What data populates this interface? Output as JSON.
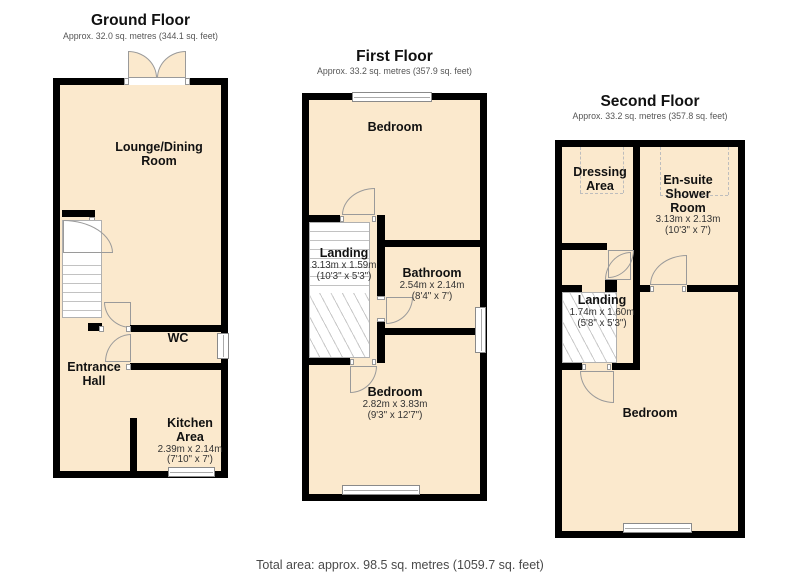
{
  "floors": {
    "ground": {
      "title": "Ground Floor",
      "subtitle": "Approx. 32.0 sq. metres (344.1 sq. feet)",
      "rooms": {
        "lounge": {
          "name": "Lounge/Dining\nRoom"
        },
        "wc": {
          "name": "WC"
        },
        "hall": {
          "name": "Entrance\nHall"
        },
        "kitchen": {
          "name": "Kitchen\nArea",
          "metric": "2.39m x 2.14m",
          "imperial": "(7'10\" x 7')"
        }
      }
    },
    "first": {
      "title": "First Floor",
      "subtitle": "Approx. 33.2 sq. metres (357.9 sq. feet)",
      "rooms": {
        "bedroom_front": {
          "name": "Bedroom"
        },
        "landing": {
          "name": "Landing",
          "metric": "3.13m x 1.59m",
          "imperial": "(10'3\" x 5'3\")"
        },
        "bathroom": {
          "name": "Bathroom",
          "metric": "2.54m x 2.14m",
          "imperial": "(8'4\" x 7')"
        },
        "bedroom_back": {
          "name": "Bedroom",
          "metric": "2.82m x 3.83m",
          "imperial": "(9'3\" x 12'7\")"
        }
      }
    },
    "second": {
      "title": "Second Floor",
      "subtitle": "Approx. 33.2 sq. metres (357.8 sq. feet)",
      "rooms": {
        "dressing": {
          "name": "Dressing\nArea"
        },
        "ensuite": {
          "name": "En-suite\nShower\nRoom",
          "metric": "3.13m x 2.13m",
          "imperial": "(10'3\" x 7')"
        },
        "landing": {
          "name": "Landing",
          "metric": "1.74m x 1.60m",
          "imperial": "(5'8\" x 5'3\")"
        },
        "bedroom": {
          "name": "Bedroom"
        }
      }
    }
  },
  "footer": {
    "total_area": "Total area: approx. 98.5 sq. metres (1059.7 sq. feet)"
  },
  "colors": {
    "wall": "#000000",
    "floor_fill": "#fbe9cd",
    "outline": "#9a9a9a"
  }
}
